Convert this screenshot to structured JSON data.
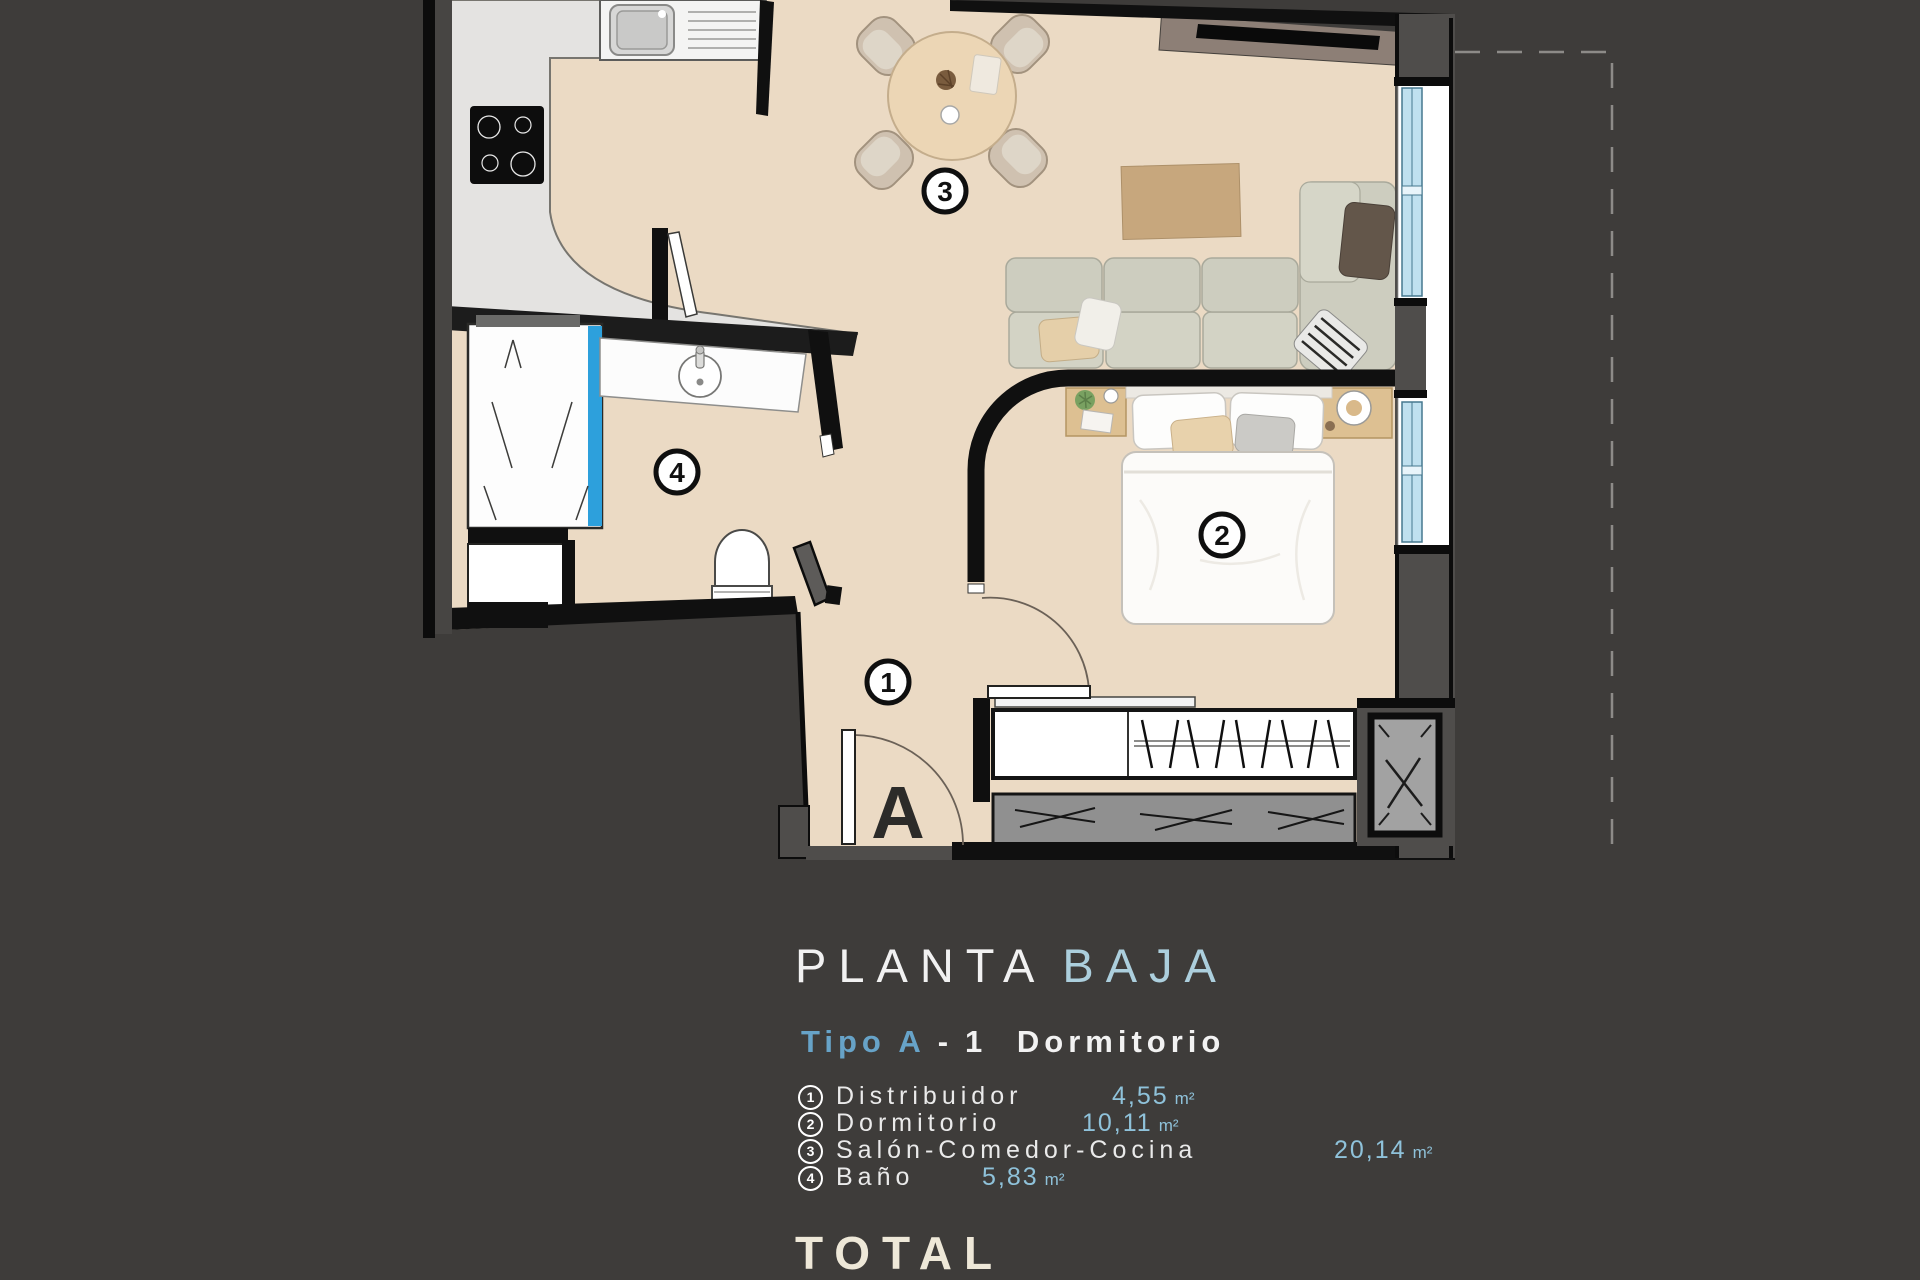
{
  "title": {
    "main": "PLANTA",
    "accent": "BAJA"
  },
  "subtitle": {
    "accent": "Tipo A",
    "separator": "-",
    "rest": "1 Dormitorio"
  },
  "legend": [
    {
      "num": "1",
      "name": "Distribuidor",
      "area": "4,55",
      "unit": "m²"
    },
    {
      "num": "2",
      "name": "Dormitorio",
      "area": "10,11",
      "unit": "m²"
    },
    {
      "num": "3",
      "name": "Salón-Comedor-Cocina",
      "area": "20,14",
      "unit": "m²"
    },
    {
      "num": "4",
      "name": "Baño",
      "area": "5,83",
      "unit": "m²"
    }
  ],
  "total_label": "TOTAL",
  "plan": {
    "entrance_letter": "A",
    "labels": [
      "1",
      "2",
      "3",
      "4"
    ]
  },
  "colors": {
    "background": "#3e3c3a",
    "floor_beige": "#ebdac4",
    "kitchen_counter": "#e4e3e1",
    "wall_black": "#101010",
    "wall_gray": "#4f4d4b",
    "window_glass": "#bfe0ef",
    "shower_glass": "#2da0dc",
    "title_accent_blue": "#accfdd",
    "type_accent_blue": "#67a3c8",
    "area_value_blue": "#8fc2da",
    "legend_text": "#eaeaea",
    "total_text": "#eee8d8"
  }
}
